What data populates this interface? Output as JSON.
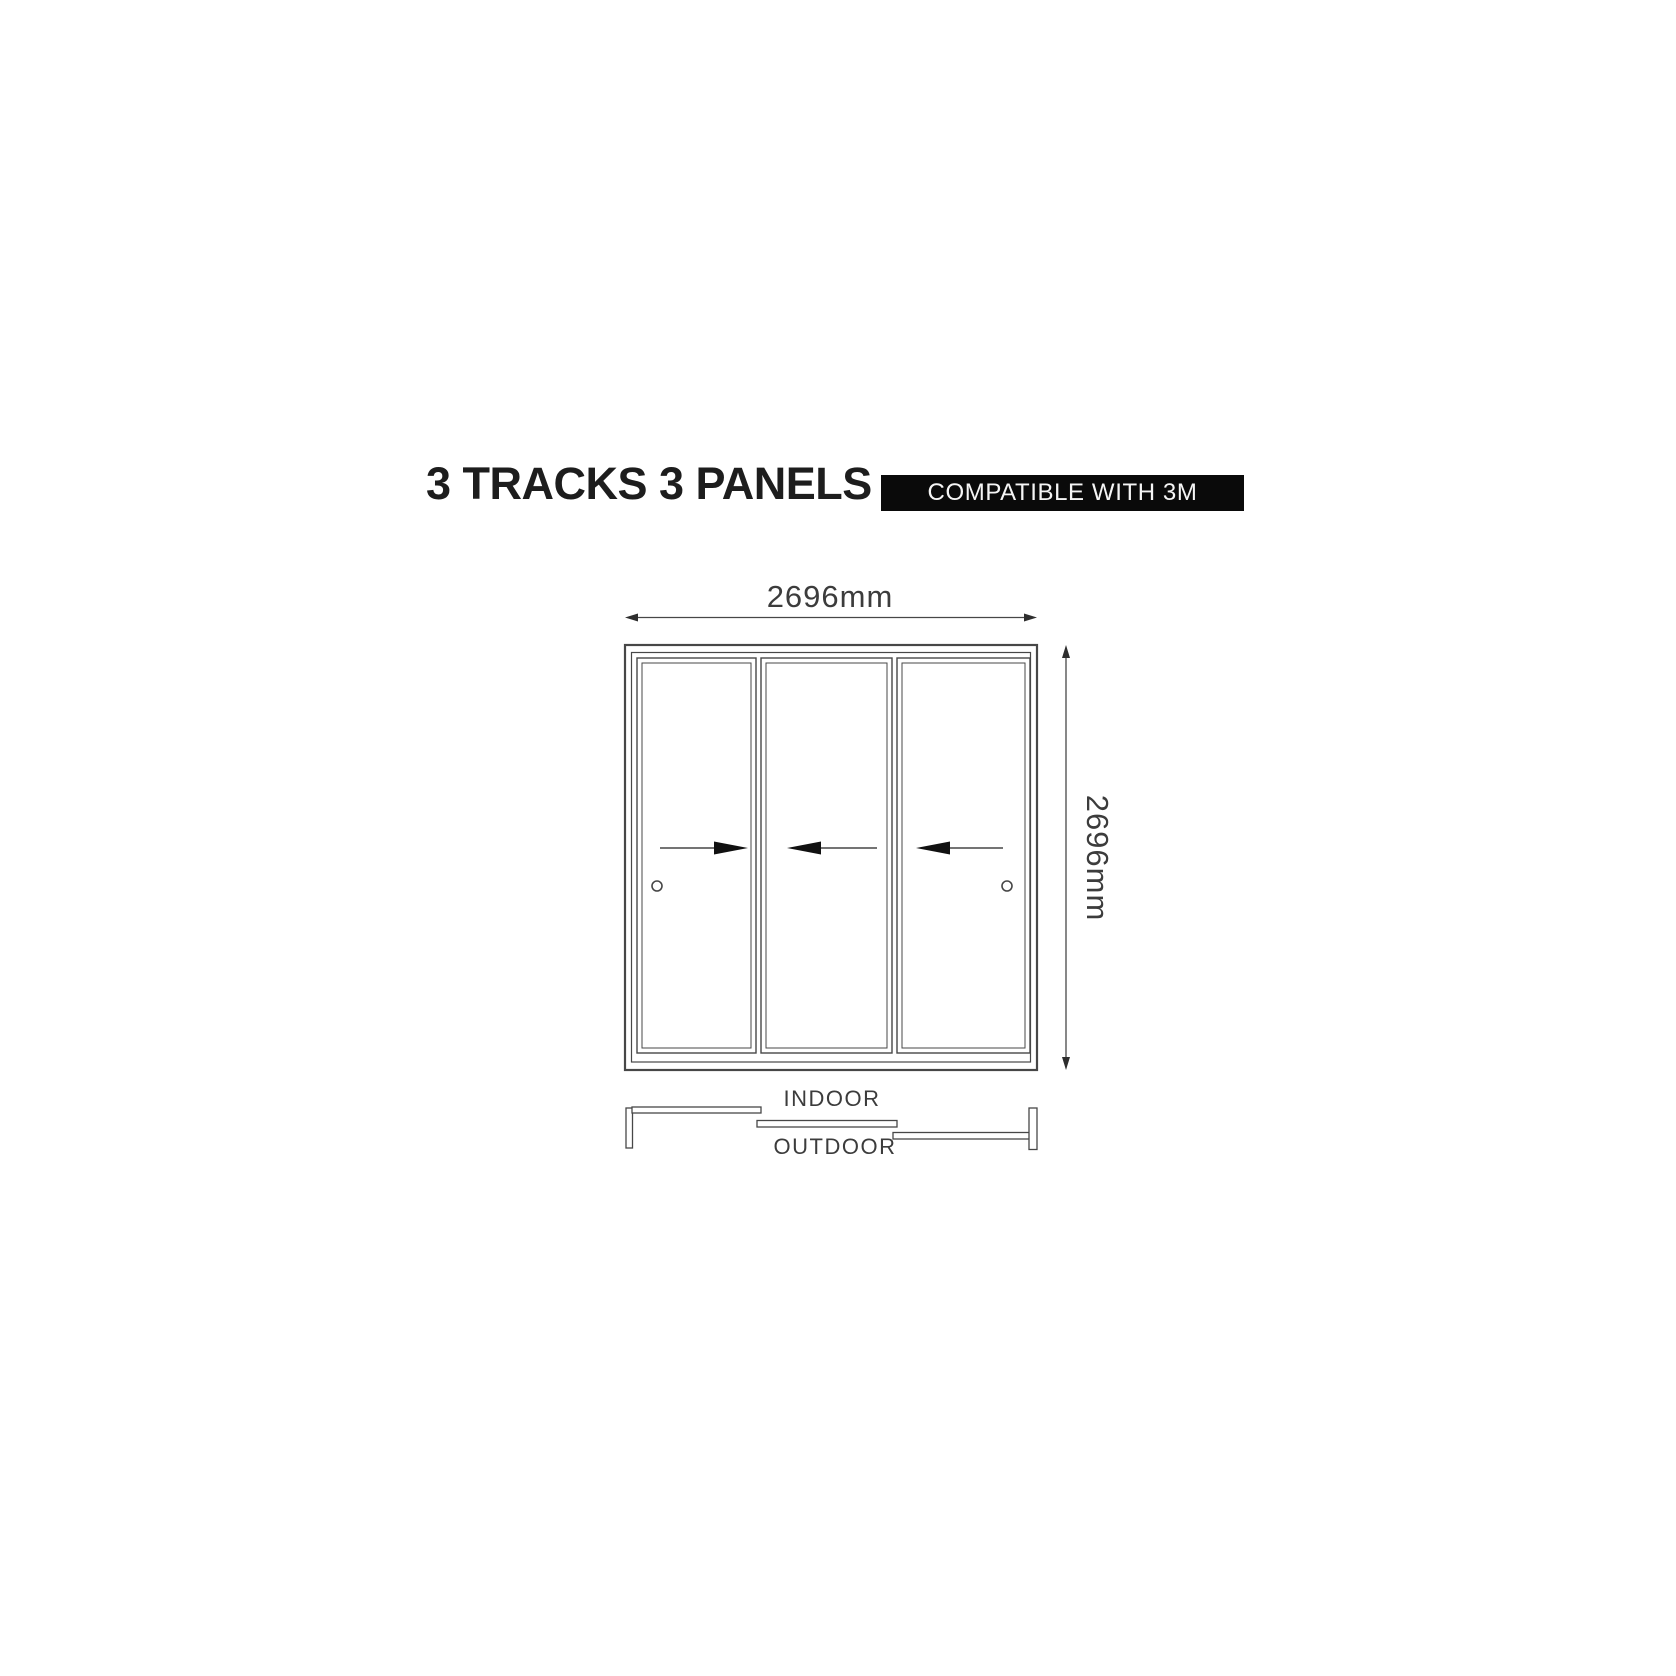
{
  "header": {
    "title": "3 TRACKS 3 PANELS",
    "badge": "COMPATIBLE WITH 3M"
  },
  "elevation": {
    "description": "3-track 3-panel sliding door elevation drawing",
    "width_label": "2696mm",
    "height_label": "2696mm",
    "tracks": 3,
    "panels": [
      {
        "id": "panel-1",
        "slide_direction": "right",
        "handle": true
      },
      {
        "id": "panel-2",
        "slide_direction": "left",
        "handle": false
      },
      {
        "id": "panel-3",
        "slide_direction": "left",
        "handle": true
      }
    ]
  },
  "plan_view": {
    "indoor_label": "INDOOR",
    "outdoor_label": "OUTDOOR"
  },
  "colors": {
    "background": "#ffffff",
    "line": "#474747",
    "dim_text": "#3c3c3c",
    "title_text": "#1d1d1d",
    "badge_background": "#0a0a0a",
    "badge_text": "#f5f5f5",
    "arrow": "#111111"
  }
}
